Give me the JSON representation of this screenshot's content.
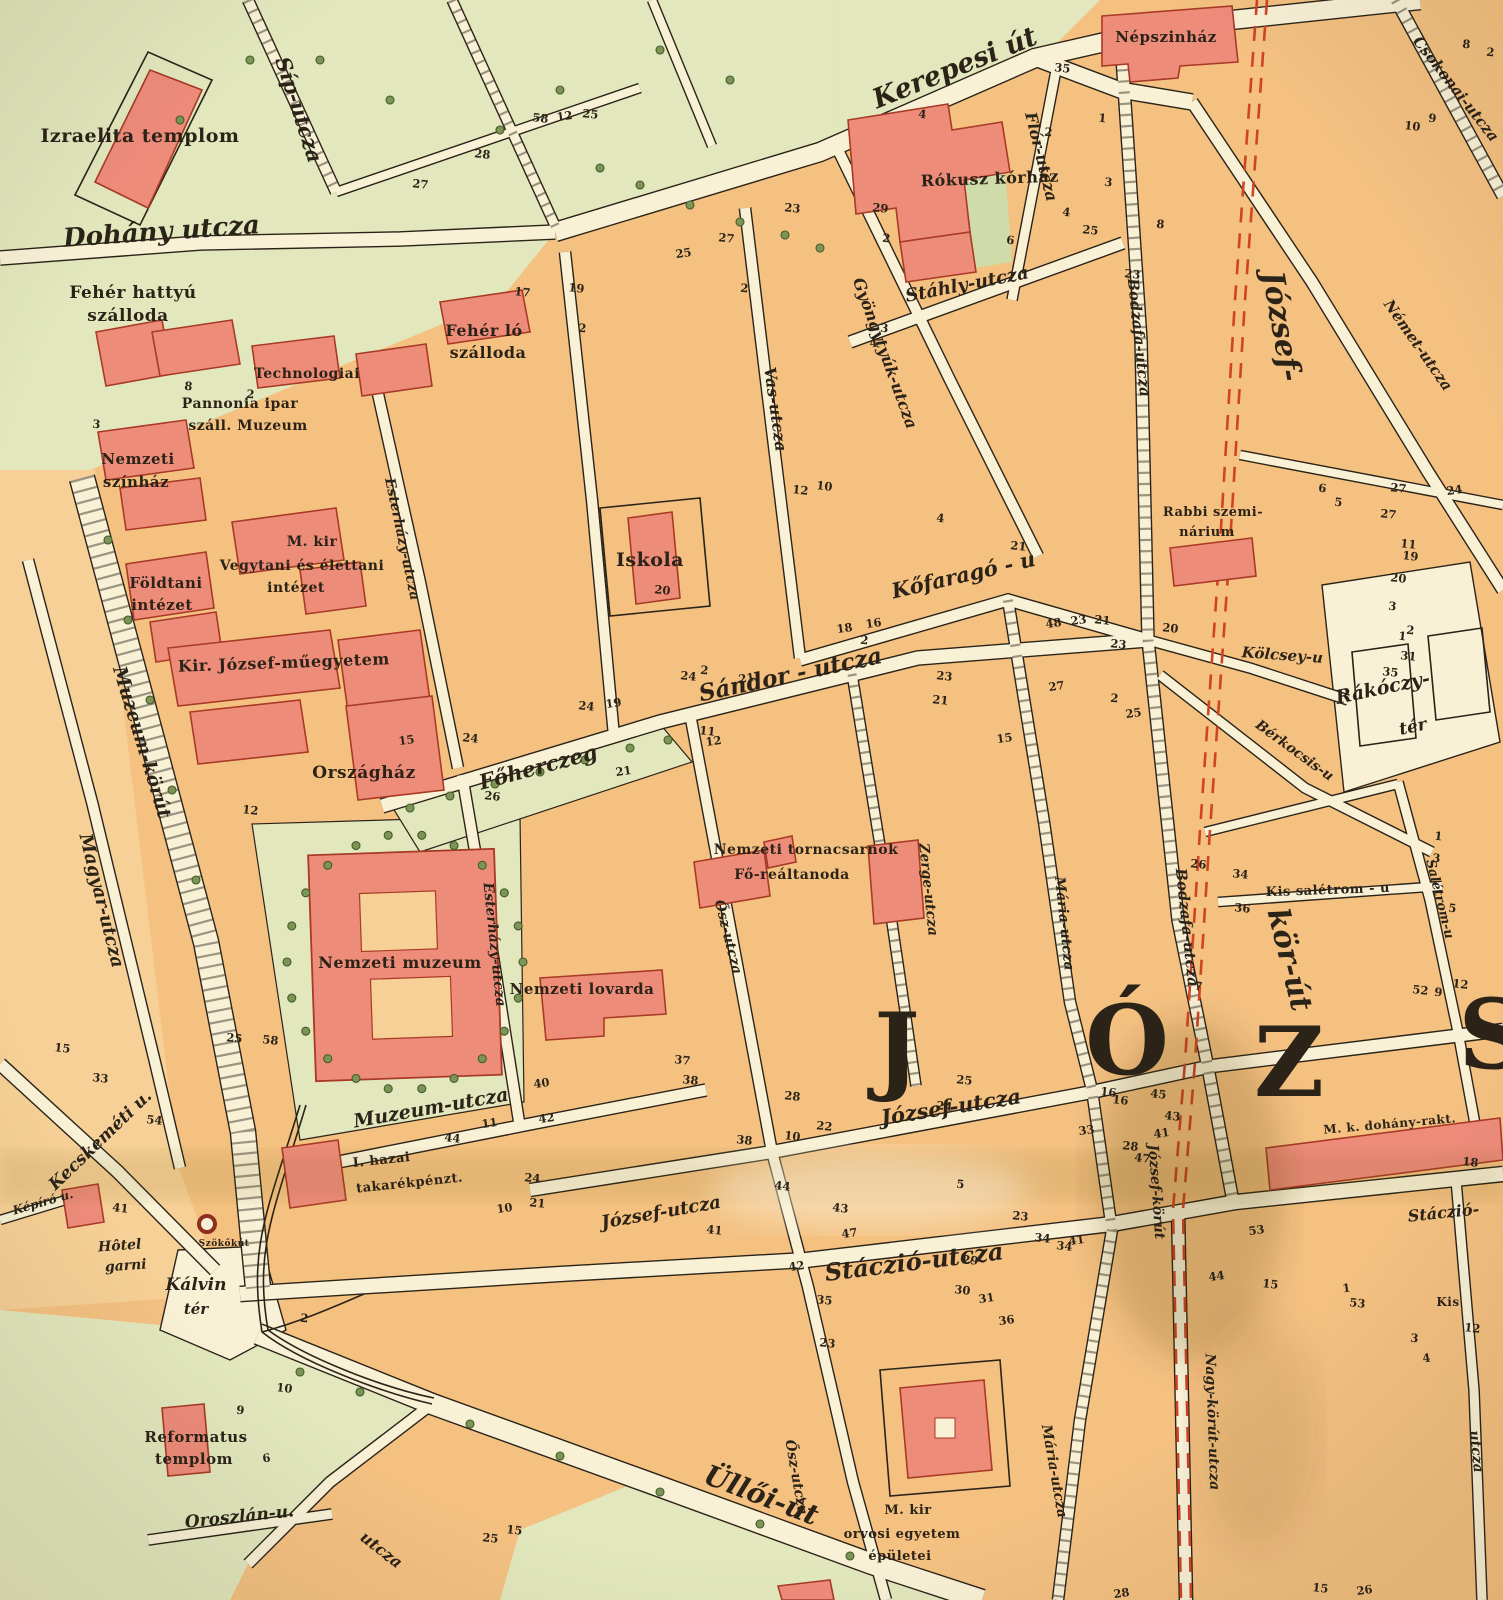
{
  "map": {
    "title": "Budapest - Józsefváros (historic city map sheet)",
    "colors": {
      "paper": "#f1e6c2",
      "block": "#f4c181",
      "block_light": "#f6d096",
      "street": "#f9f1d6",
      "green": "#e2e7bd",
      "green_dark": "#cfdba8",
      "building": "#ee8c7a",
      "building_stroke": "#a83a26",
      "ink": "#2b2318",
      "korut_dash": "#d04424",
      "tree": "#7d9455",
      "tree_stroke": "#435c2c"
    },
    "district_letters": [
      {
        "t": "J",
        "x": 898,
        "y": 1082
      },
      {
        "t": "Ó",
        "x": 1128,
        "y": 1074
      },
      {
        "t": "Z",
        "x": 1290,
        "y": 1096
      },
      {
        "t": "S",
        "x": 1494,
        "y": 1068
      }
    ],
    "street_labels": [
      {
        "t": "Dohány utcza",
        "x": 162,
        "y": 240,
        "r": -4,
        "s": 26
      },
      {
        "t": "Síp-utcza",
        "x": 292,
        "y": 112,
        "r": 72,
        "s": 21
      },
      {
        "t": "Kerepesi út",
        "x": 958,
        "y": 76,
        "r": -22,
        "s": 27
      },
      {
        "t": "Flór-utcza",
        "x": 1036,
        "y": 158,
        "r": 76,
        "s": 16
      },
      {
        "t": "Stáhly-utcza",
        "x": 968,
        "y": 290,
        "r": -11,
        "s": 18
      },
      {
        "t": "Gyöngytyúk-utcza",
        "x": 880,
        "y": 355,
        "r": 70,
        "s": 16
      },
      {
        "t": "Vas-utcza",
        "x": 770,
        "y": 410,
        "r": 82,
        "s": 16
      },
      {
        "t": "Kőfaragó - u",
        "x": 965,
        "y": 582,
        "r": -13,
        "s": 21
      },
      {
        "t": "Csokonai-utcza",
        "x": 1452,
        "y": 92,
        "r": 52,
        "s": 15
      },
      {
        "t": "Német-utcza",
        "x": 1414,
        "y": 348,
        "r": 55,
        "s": 15
      },
      {
        "t": "Bodzafa-utcza",
        "x": 1134,
        "y": 338,
        "r": 84,
        "s": 15
      },
      {
        "t": "Bodzafa-utcza",
        "x": 1182,
        "y": 928,
        "r": 84,
        "s": 15
      },
      {
        "t": "József-",
        "x": 1272,
        "y": 328,
        "r": 80,
        "s": 30
      },
      {
        "t": "kör-út",
        "x": 1280,
        "y": 962,
        "r": 76,
        "s": 30
      },
      {
        "t": "Kölcsey-u",
        "x": 1282,
        "y": 660,
        "r": 4,
        "s": 15
      },
      {
        "t": "Rákóczy-",
        "x": 1384,
        "y": 694,
        "r": -12,
        "s": 19
      },
      {
        "t": "tér",
        "x": 1414,
        "y": 732,
        "r": -12,
        "s": 17
      },
      {
        "t": "Bérkocsis-u",
        "x": 1292,
        "y": 754,
        "r": 36,
        "s": 14
      },
      {
        "t": "Főherczeg",
        "x": 540,
        "y": 774,
        "r": -15,
        "s": 21
      },
      {
        "t": "Sándor - utcza",
        "x": 792,
        "y": 682,
        "r": -12,
        "s": 23
      },
      {
        "t": "Esterházy-utcza",
        "x": 398,
        "y": 540,
        "r": 78,
        "s": 14
      },
      {
        "t": "Esterházy-utcza",
        "x": 490,
        "y": 945,
        "r": 84,
        "s": 14
      },
      {
        "t": "Zerge-utcza",
        "x": 924,
        "y": 890,
        "r": 84,
        "s": 14
      },
      {
        "t": "Mária-utcza",
        "x": 1060,
        "y": 924,
        "r": 84,
        "s": 14
      },
      {
        "t": "Mária-utcza",
        "x": 1050,
        "y": 1472,
        "r": 80,
        "s": 14
      },
      {
        "t": "Ősz-utcza",
        "x": 724,
        "y": 938,
        "r": 76,
        "s": 14
      },
      {
        "t": "Ősz-utcza",
        "x": 792,
        "y": 1478,
        "r": 80,
        "s": 14
      },
      {
        "t": "Muzeum-utcza",
        "x": 432,
        "y": 1114,
        "r": -10,
        "s": 19
      },
      {
        "t": "Muzeum-körút",
        "x": 136,
        "y": 744,
        "r": 73,
        "s": 19
      },
      {
        "t": "Magyar-utcza",
        "x": 96,
        "y": 902,
        "r": 76,
        "s": 18
      },
      {
        "t": "Kecskeméti u.",
        "x": 104,
        "y": 1144,
        "r": -44,
        "s": 17
      },
      {
        "t": "Képíró u.",
        "x": 44,
        "y": 1206,
        "r": -16,
        "s": 12
      },
      {
        "t": "Kálvin",
        "x": 196,
        "y": 1290,
        "r": 0,
        "s": 17
      },
      {
        "t": "tér",
        "x": 196,
        "y": 1314,
        "r": 0,
        "s": 15
      },
      {
        "t": "Oroszlán-u.",
        "x": 240,
        "y": 1522,
        "r": -6,
        "s": 17
      },
      {
        "t": "József-utcza",
        "x": 952,
        "y": 1114,
        "r": -9,
        "s": 21
      },
      {
        "t": "József-utcza",
        "x": 662,
        "y": 1218,
        "r": -10,
        "s": 18
      },
      {
        "t": "Stáczió-utcza",
        "x": 915,
        "y": 1270,
        "r": -7,
        "s": 24
      },
      {
        "t": "Stáczió-",
        "x": 1444,
        "y": 1218,
        "r": -6,
        "s": 16
      },
      {
        "t": "utcza",
        "x": 1472,
        "y": 1452,
        "r": 84,
        "s": 14
      },
      {
        "t": "Üllői-út",
        "x": 758,
        "y": 1504,
        "r": 21,
        "s": 28
      },
      {
        "t": "utcza",
        "x": 378,
        "y": 1554,
        "r": 38,
        "s": 16
      },
      {
        "t": "József-körút",
        "x": 1152,
        "y": 1192,
        "r": 86,
        "s": 14
      },
      {
        "t": "Nagy-körút-utcza",
        "x": 1208,
        "y": 1422,
        "r": 88,
        "s": 14
      },
      {
        "t": "Salétrom-u",
        "x": 1436,
        "y": 900,
        "r": 76,
        "s": 13
      }
    ],
    "place_labels": [
      {
        "t": "Izraelita templom",
        "x": 140,
        "y": 142,
        "r": 0,
        "s": 19
      },
      {
        "t": "Fehér hattyú",
        "x": 133,
        "y": 298,
        "r": 0,
        "s": 17
      },
      {
        "t": "szálloda",
        "x": 128,
        "y": 321,
        "r": 0,
        "s": 17
      },
      {
        "t": "Fehér ló",
        "x": 484,
        "y": 336,
        "r": 0,
        "s": 16
      },
      {
        "t": "szálloda",
        "x": 488,
        "y": 358,
        "r": 0,
        "s": 16
      },
      {
        "t": "Technologiai",
        "x": 307,
        "y": 378,
        "r": 0,
        "s": 14
      },
      {
        "t": "Pannonia ipar",
        "x": 240,
        "y": 408,
        "r": 0,
        "s": 14
      },
      {
        "t": "száll. Muzeum",
        "x": 248,
        "y": 430,
        "r": 0,
        "s": 14
      },
      {
        "t": "Nemzeti",
        "x": 138,
        "y": 464,
        "r": 0,
        "s": 15
      },
      {
        "t": "színház",
        "x": 136,
        "y": 487,
        "r": 0,
        "s": 15
      },
      {
        "t": "M. kir",
        "x": 312,
        "y": 546,
        "r": 0,
        "s": 14
      },
      {
        "t": "Vegytani és élettani",
        "x": 302,
        "y": 570,
        "r": 0,
        "s": 14
      },
      {
        "t": "intézet",
        "x": 296,
        "y": 592,
        "r": 0,
        "s": 14
      },
      {
        "t": "Földtani",
        "x": 166,
        "y": 588,
        "r": 0,
        "s": 15
      },
      {
        "t": "intézet",
        "x": 162,
        "y": 610,
        "r": 0,
        "s": 15
      },
      {
        "t": "Kir. József-műegyetem",
        "x": 284,
        "y": 668,
        "r": -2,
        "s": 16
      },
      {
        "t": "Országház",
        "x": 364,
        "y": 778,
        "r": 0,
        "s": 17
      },
      {
        "t": "Iskola",
        "x": 650,
        "y": 566,
        "r": 0,
        "s": 19
      },
      {
        "t": "Népszinház",
        "x": 1166,
        "y": 42,
        "r": 0,
        "s": 15
      },
      {
        "t": "Rókusz kórház",
        "x": 990,
        "y": 184,
        "r": -2,
        "s": 16
      },
      {
        "t": "Stáhly-utcza",
        "x": 0,
        "y": -9999,
        "r": 0,
        "s": 1
      },
      {
        "t": "Rabbi szemi-",
        "x": 1213,
        "y": 516,
        "r": 0,
        "s": 13
      },
      {
        "t": "nárium",
        "x": 1207,
        "y": 536,
        "r": 0,
        "s": 13
      },
      {
        "t": "Kis salétrom - u",
        "x": 1328,
        "y": 894,
        "r": -2,
        "s": 13
      },
      {
        "t": "Nemzeti tornacsarnok",
        "x": 806,
        "y": 854,
        "r": 0,
        "s": 14
      },
      {
        "t": "Fő-reáltanoda",
        "x": 792,
        "y": 879,
        "r": 0,
        "s": 14
      },
      {
        "t": "Nemzeti muzeum",
        "x": 400,
        "y": 968,
        "r": 0,
        "s": 16
      },
      {
        "t": "Nemzeti lovarda",
        "x": 582,
        "y": 994,
        "r": 0,
        "s": 15
      },
      {
        "t": "I. hazai",
        "x": 382,
        "y": 1164,
        "r": -6,
        "s": 13
      },
      {
        "t": "takarékpénzt.",
        "x": 410,
        "y": 1187,
        "r": -6,
        "s": 13
      },
      {
        "t": "Szökőkút",
        "x": 224,
        "y": 1246,
        "r": 0,
        "s": 9
      },
      {
        "t": "Reformatus",
        "x": 196,
        "y": 1442,
        "r": 0,
        "s": 15
      },
      {
        "t": "templom",
        "x": 194,
        "y": 1464,
        "r": 0,
        "s": 15
      },
      {
        "t": "M. kir",
        "x": 908,
        "y": 1514,
        "r": 0,
        "s": 13
      },
      {
        "t": "orvosi egyetem",
        "x": 902,
        "y": 1538,
        "r": 0,
        "s": 13
      },
      {
        "t": "épületei",
        "x": 900,
        "y": 1560,
        "r": 0,
        "s": 13
      },
      {
        "t": "M. k. dohány-rakt.",
        "x": 1390,
        "y": 1128,
        "r": -5,
        "s": 12
      },
      {
        "t": "Kis",
        "x": 1448,
        "y": 1306,
        "r": 0,
        "s": 12
      }
    ],
    "italic_place_labels": [
      {
        "t": "Hôtel",
        "x": 120,
        "y": 1250,
        "r": -4,
        "s": 14
      },
      {
        "t": "garni",
        "x": 126,
        "y": 1270,
        "r": -4,
        "s": 14
      }
    ],
    "house_numbers": [
      [
        "35",
        1062,
        72
      ],
      [
        "1",
        1102,
        122
      ],
      [
        "2",
        1048,
        136
      ],
      [
        "3",
        1108,
        186
      ],
      [
        "4",
        1066,
        216
      ],
      [
        "25",
        1090,
        234
      ],
      [
        "23",
        1132,
        278
      ],
      [
        "8",
        1160,
        228
      ],
      [
        "8",
        1466,
        48
      ],
      [
        "2",
        1490,
        56
      ],
      [
        "9",
        1432,
        122
      ],
      [
        "10",
        1412,
        130
      ],
      [
        "27",
        1398,
        492
      ],
      [
        "24",
        1455,
        494
      ],
      [
        "19",
        1410,
        560
      ],
      [
        "20",
        1398,
        582
      ],
      [
        "3",
        1392,
        610
      ],
      [
        "1",
        1402,
        640
      ],
      [
        "6",
        1322,
        492
      ],
      [
        "5",
        1338,
        506
      ],
      [
        "11",
        1408,
        548
      ],
      [
        "2",
        1410,
        634
      ],
      [
        "17",
        522,
        296
      ],
      [
        "19",
        576,
        292
      ],
      [
        "2",
        582,
        332
      ],
      [
        "25",
        684,
        257
      ],
      [
        "27",
        726,
        242
      ],
      [
        "2",
        744,
        292
      ],
      [
        "23",
        792,
        212
      ],
      [
        "29",
        880,
        212
      ],
      [
        "4",
        874,
        347
      ],
      [
        "3",
        884,
        332
      ],
      [
        "2",
        886,
        242
      ],
      [
        "6",
        1010,
        244
      ],
      [
        "12",
        800,
        494
      ],
      [
        "10",
        824,
        490
      ],
      [
        "4",
        940,
        522
      ],
      [
        "21",
        1018,
        550
      ],
      [
        "16",
        874,
        627
      ],
      [
        "18",
        845,
        632
      ],
      [
        "2",
        864,
        644
      ],
      [
        "21",
        747,
        682
      ],
      [
        "48",
        1054,
        627
      ],
      [
        "23",
        1079,
        624
      ],
      [
        "20",
        1170,
        632
      ],
      [
        "20",
        662,
        594
      ],
      [
        "24",
        688,
        680
      ],
      [
        "2",
        704,
        674
      ],
      [
        "24",
        586,
        710
      ],
      [
        "19",
        614,
        707
      ],
      [
        "15",
        407,
        744
      ],
      [
        "24",
        470,
        742
      ],
      [
        "12",
        714,
        745
      ],
      [
        "11",
        707,
        735
      ],
      [
        "21",
        624,
        775
      ],
      [
        "26",
        492,
        800
      ],
      [
        "23",
        944,
        680
      ],
      [
        "21",
        940,
        704
      ],
      [
        "27",
        1057,
        690
      ],
      [
        "2",
        1114,
        702
      ],
      [
        "25",
        1134,
        717
      ],
      [
        "12",
        250,
        814
      ],
      [
        "33",
        100,
        1082
      ],
      [
        "54",
        154,
        1124
      ],
      [
        "15",
        62,
        1052
      ],
      [
        "25",
        234,
        1042
      ],
      [
        "58",
        270,
        1044
      ],
      [
        "41",
        120,
        1212
      ],
      [
        "10",
        505,
        1212
      ],
      [
        "44",
        452,
        1142
      ],
      [
        "42",
        547,
        1122
      ],
      [
        "11",
        490,
        1127
      ],
      [
        "40",
        542,
        1087
      ],
      [
        "37",
        682,
        1064
      ],
      [
        "38",
        690,
        1084
      ],
      [
        "38",
        744,
        1144
      ],
      [
        "10",
        792,
        1140
      ],
      [
        "44",
        782,
        1190
      ],
      [
        "41",
        714,
        1234
      ],
      [
        "24",
        532,
        1182
      ],
      [
        "21",
        537,
        1207
      ],
      [
        "47",
        850,
        1237
      ],
      [
        "43",
        840,
        1212
      ],
      [
        "42",
        797,
        1270
      ],
      [
        "35",
        824,
        1304
      ],
      [
        "28",
        792,
        1100
      ],
      [
        "22",
        824,
        1130
      ],
      [
        "25",
        964,
        1084
      ],
      [
        "24",
        944,
        1110
      ],
      [
        "16",
        1120,
        1104
      ],
      [
        "28",
        1130,
        1150
      ],
      [
        "33",
        1087,
        1134
      ],
      [
        "41",
        1162,
        1137
      ],
      [
        "53",
        1257,
        1234
      ],
      [
        "34",
        1042,
        1242
      ],
      [
        "41",
        1077,
        1244
      ],
      [
        "23",
        1020,
        1220
      ],
      [
        "29",
        970,
        1264
      ],
      [
        "30",
        962,
        1294
      ],
      [
        "31",
        987,
        1302
      ],
      [
        "36",
        1007,
        1324
      ],
      [
        "23",
        827,
        1347
      ],
      [
        "25",
        490,
        1542
      ],
      [
        "15",
        514,
        1534
      ],
      [
        "2",
        304,
        1322
      ],
      [
        "10",
        284,
        1392
      ],
      [
        "9",
        240,
        1414
      ],
      [
        "6",
        267,
        1462
      ],
      [
        "5",
        960,
        1188
      ],
      [
        "15",
        1270,
        1288
      ],
      [
        "1",
        1347,
        1292
      ],
      [
        "53",
        1357,
        1307
      ],
      [
        "3",
        1414,
        1342
      ],
      [
        "4",
        1427,
        1362
      ],
      [
        "12",
        1472,
        1332
      ],
      [
        "44",
        1217,
        1280
      ],
      [
        "34",
        1064,
        1250
      ],
      [
        "15",
        1320,
        1592
      ],
      [
        "26",
        1365,
        1594
      ],
      [
        "28",
        1122,
        1597
      ],
      [
        "34",
        1240,
        878
      ],
      [
        "36",
        1242,
        912
      ],
      [
        "3",
        1436,
        862
      ],
      [
        "5",
        1452,
        912
      ],
      [
        "1",
        1438,
        840
      ],
      [
        "43",
        1172,
        1120
      ],
      [
        "45",
        1158,
        1098
      ],
      [
        "47",
        1142,
        1162
      ],
      [
        "27",
        1388,
        518
      ],
      [
        "12",
        1460,
        988
      ],
      [
        "9",
        1438,
        996
      ],
      [
        "52",
        1420,
        994
      ],
      [
        "15",
        1005,
        742
      ],
      [
        "31",
        1408,
        660
      ],
      [
        "35",
        1390,
        676
      ],
      [
        "26",
        1198,
        868
      ],
      [
        "21",
        1102,
        624
      ],
      [
        "23",
        1118,
        648
      ],
      [
        "7",
        1198,
        990
      ],
      [
        "16",
        1108,
        1096
      ],
      [
        "12",
        565,
        120
      ],
      [
        "25",
        590,
        118
      ],
      [
        "28",
        482,
        158
      ],
      [
        "27",
        420,
        188
      ],
      [
        "58",
        540,
        122
      ],
      [
        "3",
        96,
        428
      ],
      [
        "8",
        188,
        390
      ],
      [
        "2",
        250,
        398
      ],
      [
        "4",
        922,
        118
      ],
      [
        "18",
        1470,
        1166
      ]
    ]
  }
}
